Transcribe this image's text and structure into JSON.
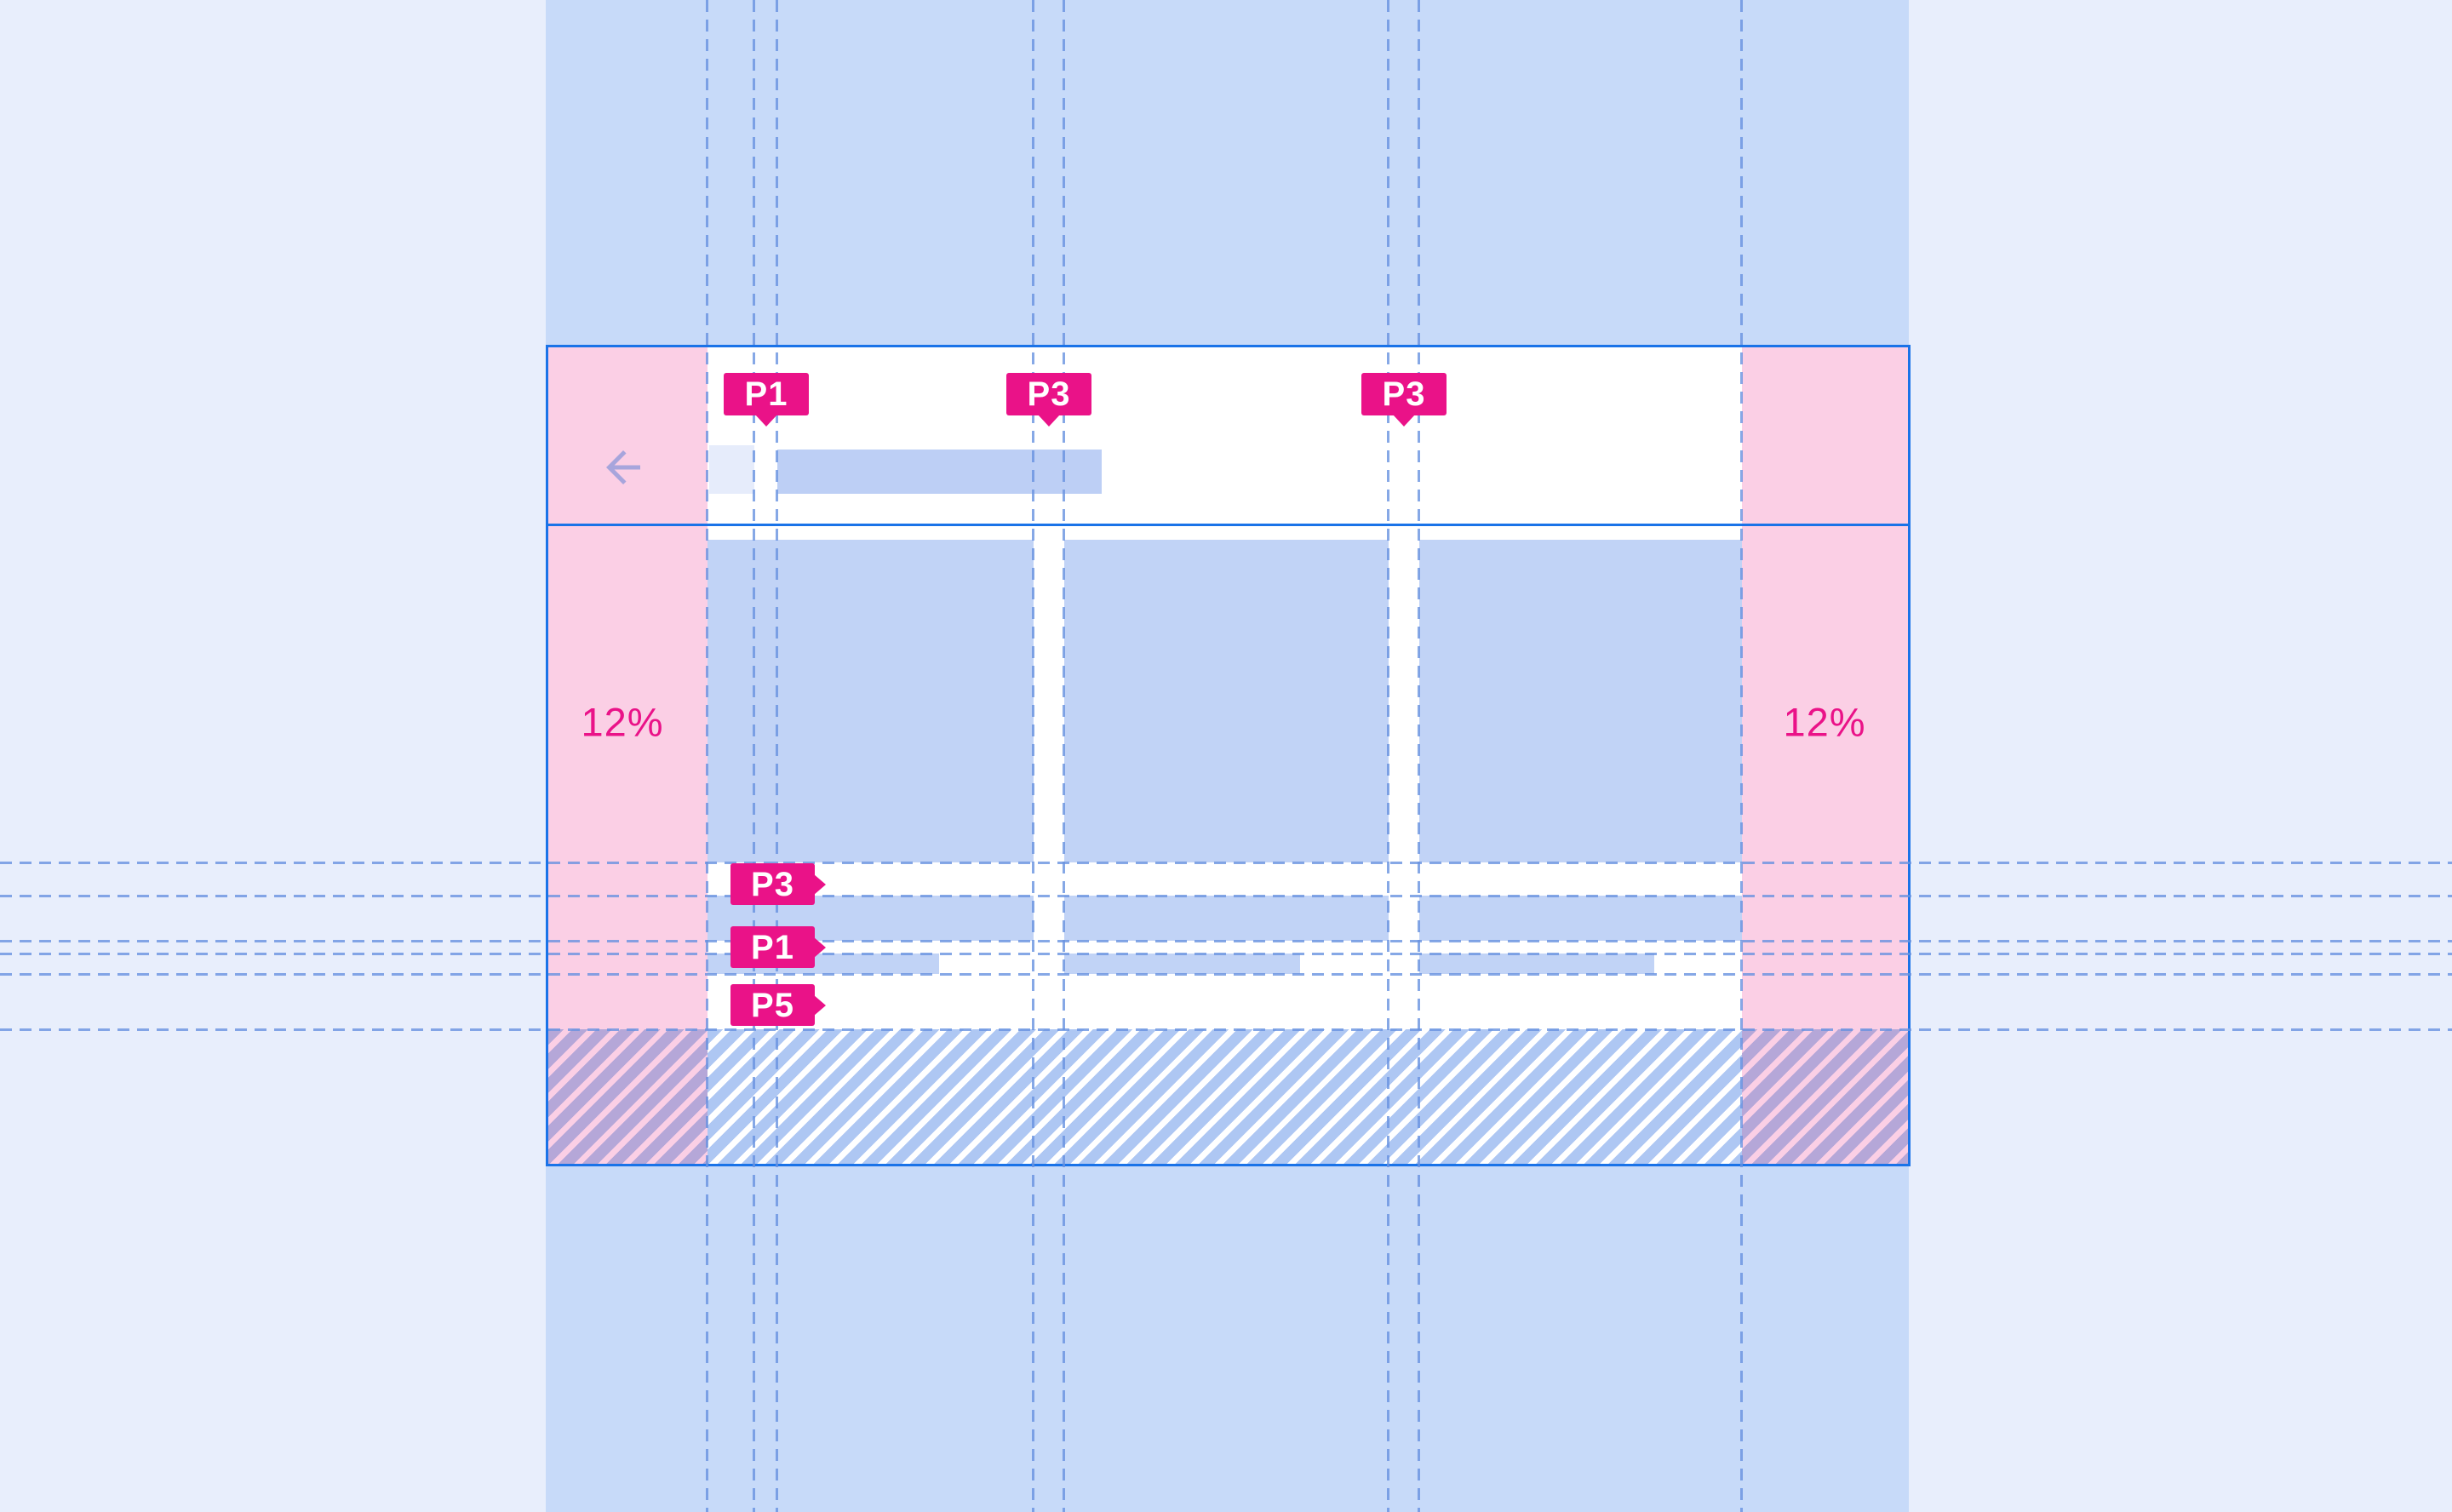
{
  "diagram": {
    "type": "responsive-layout-spec",
    "margins": {
      "left_label": "12%",
      "right_label": "12%"
    },
    "markers": {
      "top": [
        {
          "label": "P1"
        },
        {
          "label": "P3"
        },
        {
          "label": "P3"
        }
      ],
      "side": [
        {
          "label": "P3"
        },
        {
          "label": "P1"
        },
        {
          "label": "P5"
        }
      ]
    },
    "icons": {
      "back_arrow": "arrow-back-icon"
    },
    "colors": {
      "page_background": "#e8eefc",
      "band_blue": "#c7daf9",
      "frame_accent_blue": "#1a73e8",
      "margin_pink": "#fbcfe5",
      "placeholder_blue": "#c1d3f6",
      "title_placeholder_blue": "#bdcff5",
      "icon_box_blue": "#e6ecfb",
      "marker_magenta": "#ea1288",
      "guide_blue": "#7da4e8",
      "hatch_stripe_blue": "#aec7f3",
      "hatch_stripe_purple": "#b5a7d8",
      "arrow_lavender": "#a7a5dc"
    }
  }
}
